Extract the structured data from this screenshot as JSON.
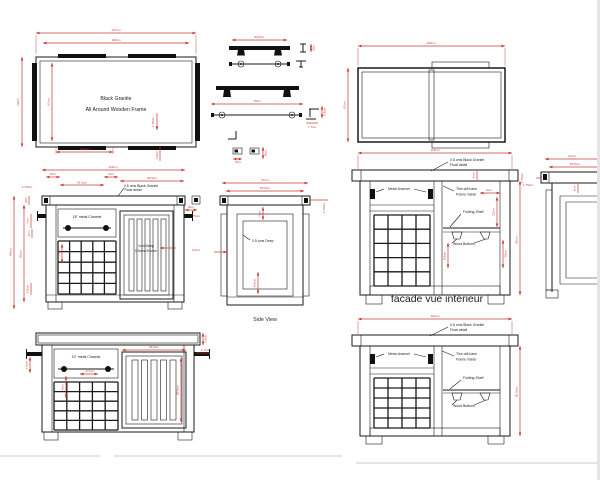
{
  "colors": {
    "line": "#1a1a1a",
    "dimension": "#c43b36",
    "background": "#ffffff"
  },
  "plan": {
    "w_outer": "127cm",
    "w_inner": "115cm",
    "h_outer": "79cm",
    "h_inner": "67cm",
    "material1": "Black Granite",
    "material2": "All Around Wooden Frame",
    "d_bottom": "48.5cm",
    "d_thick": "1.75cm",
    "d_edge": "4.8cm"
  },
  "handles": {
    "d_short": "40.5cm",
    "d_short_h": "3cm",
    "d_long": "70cm",
    "d_rise": "1.8cm",
    "d_depth": "7.7cm",
    "d_sq_w": "3cm",
    "d_sq_h": "8cm"
  },
  "panel": {
    "w": "115cm",
    "h": "87cm"
  },
  "front": {
    "w": "115cm",
    "d8": "8cm",
    "d41_5": "41.5cm",
    "d4": "4cm",
    "d49_5": "49.5cm",
    "d175_left": "1.75cm",
    "note1": "0.5 cms Black Granite",
    "note2": "Float detail",
    "d8_right": "8cm",
    "d175_right": "1.75cm",
    "channel": "18\" metal Channel",
    "h_outer": "86cm",
    "h_inner": "80cm",
    "d3": "3cm",
    "d7": "7cm",
    "d4b": "4cm",
    "d14": "14cm",
    "d25": "2.5cm",
    "groove1": "1cm Deep",
    "groove2": "0.5cm Groove"
  },
  "side": {
    "w_outer": "67cm",
    "w_inner": "63.5cm",
    "deep": "0.5 cms Deep",
    "d_top": "7cm",
    "d_bottom": "8.5cm",
    "d_left": "2.5cm",
    "d_right": "1.75cm",
    "caption": "Side View"
  },
  "facade_mid": {
    "w": "115cm",
    "note1": "0.5 cms Black Granite",
    "note2": "Float detail",
    "d3": "3cm",
    "d175": "1.75cm",
    "metal_channel": "Metal channel",
    "frame1": "This will have",
    "frame2": "Frame inside",
    "folding_shelf": "Folding Shelf",
    "wood_buttons": "Wood Buttons",
    "d9": "9cm",
    "d20": "20cm",
    "d23": "23cm",
    "d8_5": "8.5cm",
    "h": "80cm",
    "caption": "facade vue intérieur"
  },
  "right_partial": {
    "w_outer": "67cm",
    "w_inner": "63.5cm",
    "d175": "1.75cm",
    "d3": "3cm"
  },
  "front_bottom": {
    "channel": "10\" metal Channel",
    "d4_5": "4.5cm",
    "d1_8": "1.8cm",
    "d1_7": "1.7cm",
    "d5_7": "5.7cm",
    "d8": "8cm",
    "d49_5": "49.5cm",
    "d55_5": "55.5cm"
  },
  "facade_bottom": {
    "w": "115cm",
    "note1": "0.5 cms Black Granite",
    "note2": "Float detail",
    "metal_channel": "Metal channel",
    "frame1": "This will have",
    "frame2": "Frame inside",
    "folding_shelf": "Folding Shelf",
    "wood_buttons": "Wood Buttons",
    "h": "80.5cm"
  }
}
